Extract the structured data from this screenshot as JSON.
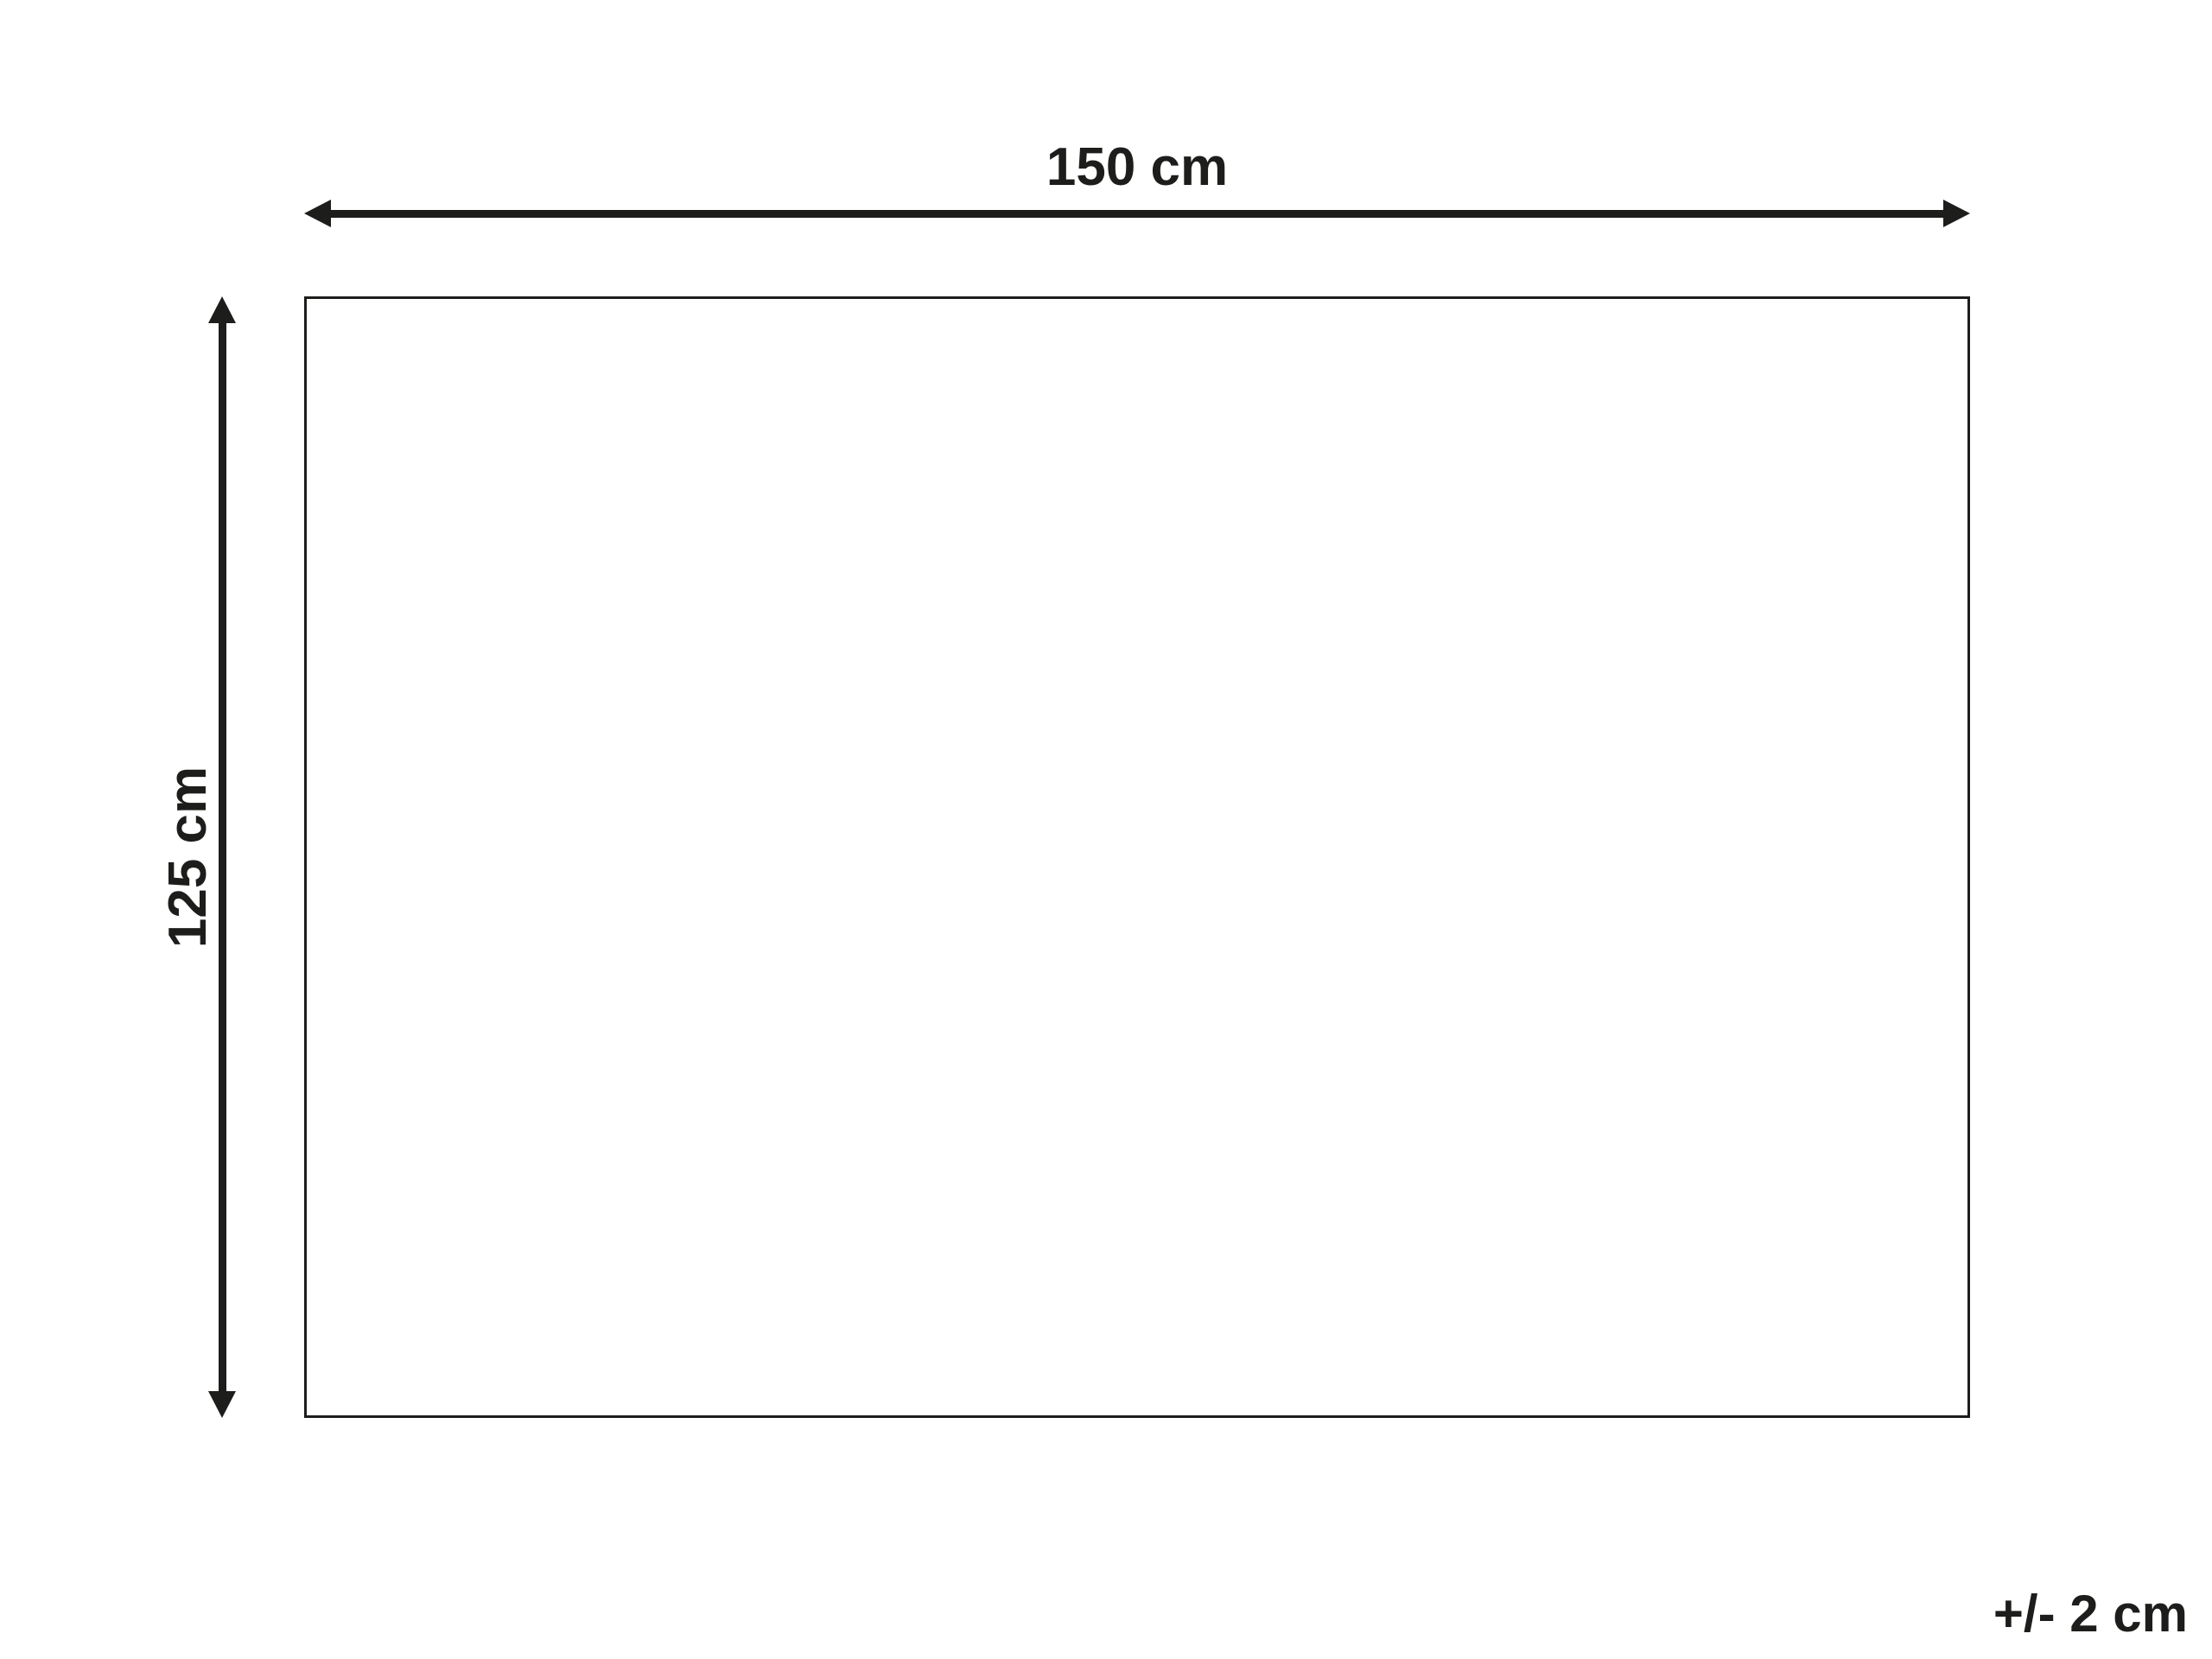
{
  "theme": {
    "ink": "#1d1d1b",
    "bg": "#ffffff"
  },
  "diagram": {
    "shape": "rectangle",
    "width_label": "150 cm",
    "height_label": "125 cm",
    "tolerance_label": "+/- 2 cm"
  }
}
